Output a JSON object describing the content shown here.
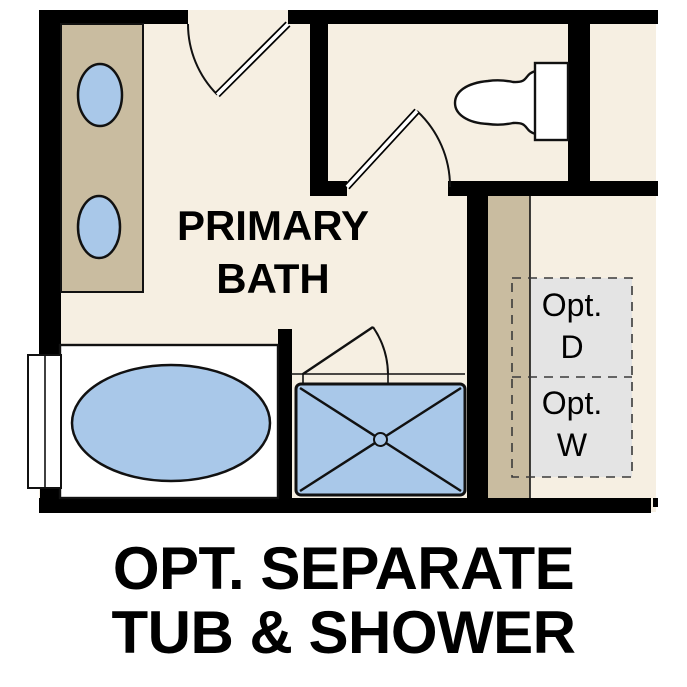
{
  "room_label": {
    "line1": "PRIMARY",
    "line2": "BATH"
  },
  "optional_appliances": {
    "dryer": {
      "line1": "Opt.",
      "line2": "D"
    },
    "washer": {
      "line1": "Opt.",
      "line2": "W"
    }
  },
  "caption": {
    "line1": "OPT. SEPARATE",
    "line2": "TUB & SHOWER"
  },
  "colors": {
    "wall": "#000000",
    "floor": "#f6efe2",
    "cabinet": "#c9bca0",
    "fixture_blue": "#a9c8e9",
    "optional_box_gray": "#e4e4e4",
    "outline": "#111111",
    "background": "#ffffff"
  }
}
